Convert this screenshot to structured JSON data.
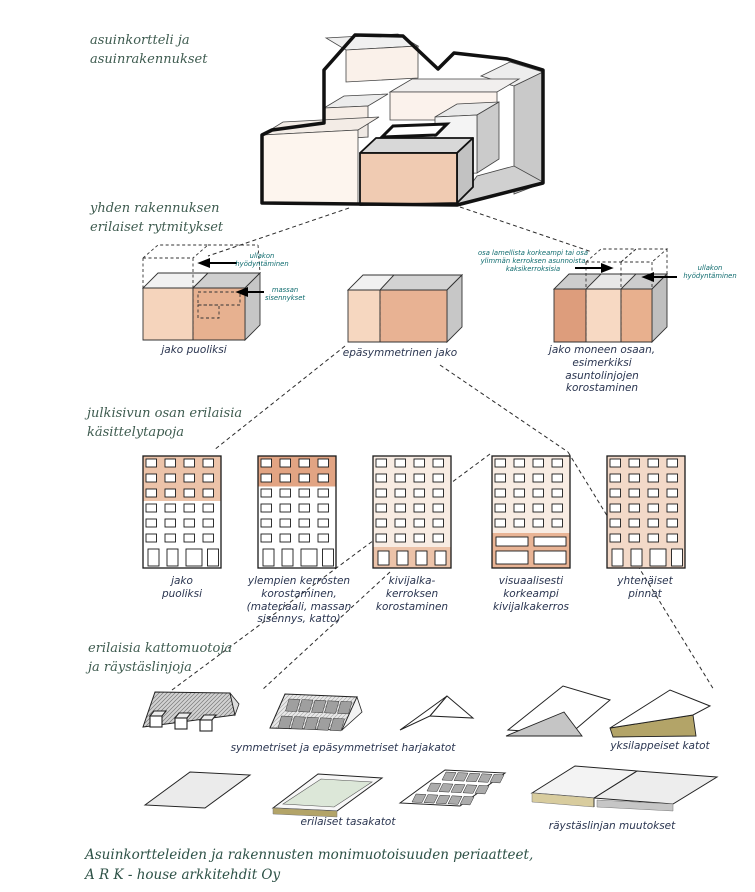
{
  "palette": {
    "label_green": "#3f5c50",
    "footer_green": "#2d5146",
    "caption_navy": "#2a3550",
    "annotation_teal": "#0e6b6e",
    "salmon_light": "#f5d4bc",
    "salmon_mid": "#ecc3a9",
    "salmon_dark": "#dd9d7c",
    "facade_pink": "#f8ece3",
    "grey_top": "#ededed",
    "grey_side": "#c9c9c9",
    "khaki": "#b3a468",
    "parapet_green": "#dce7d8"
  },
  "sections": {
    "s1": "asuinkortteli ja\nasuinrakennukset",
    "s2": "yhden rakennuksen\nerilaiset rytmitykset",
    "s3": "julkisivun osan erilaisia\nkäsittelytapoja",
    "s4": "erilaisia kattomuotoja\nja räystäslinjoja"
  },
  "blocks": {
    "b1": {
      "label": "jako puoliksi",
      "ann_attic": "ullakon\nhyödyntäminen",
      "ann_mass": "massan\nsisennykset"
    },
    "b2": {
      "label": "epäsymmetrinen jako"
    },
    "b3": {
      "label": "jako moneen osaan,\nesimerkiksi\nasuntolinjojen\nkorostaminen",
      "ann_height": "osa lamellista korkeampi tai osa\nylimmän kerroksen asunnoista\nkaksikerroksisia",
      "ann_attic": "ullakon\nhyödyntäminen"
    }
  },
  "facades": [
    {
      "label": "jako\npuoliksi"
    },
    {
      "label": "ylempien kerrosten\nkorostaminen,\n(materiaali, massan\nsisennys, katto)"
    },
    {
      "label": "kivijalka-\nkerroksen\nkorostaminen"
    },
    {
      "label": "visuaalisesti\nkorkeampi\nkivijalkakerros"
    },
    {
      "label": "yhtenäiset\npinnat"
    }
  ],
  "roofs": {
    "gable": "symmetriset ja epäsymmetriset harjakatot",
    "mono": "yksilappeiset katot",
    "flat": "erilaiset tasakatot",
    "eaves": "räystäslinjan muutokset"
  },
  "footer": {
    "text": "Asuinkortteleiden ja rakennusten monimuotoisuuden periaatteet,\nA R K - house arkkitehdit Oy"
  }
}
